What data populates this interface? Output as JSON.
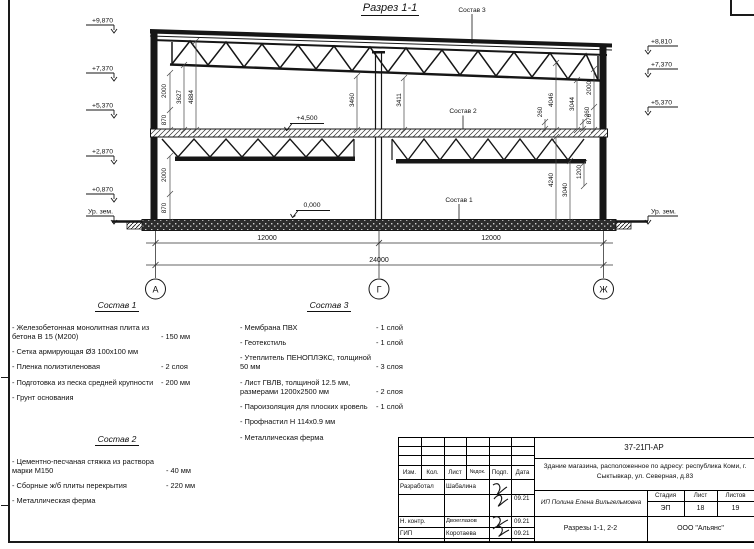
{
  "drawing": {
    "title": "Разрез 1-1",
    "callout_1": "Состав 1",
    "callout_2": "Состав 2",
    "callout_3": "Состав 3",
    "levels_left": {
      "l1": "+9,870",
      "l2": "+7,370",
      "l3": "+5,370",
      "l4": "+2,870",
      "l5": "+0,870",
      "ground": "Ур. зем."
    },
    "levels_right": {
      "l1": "+8,810",
      "l2": "+7,370",
      "l3": "+5,370",
      "ground": "Ур. зем."
    },
    "floor_levels": {
      "second": "+4,500",
      "first": "0,000"
    },
    "dims": {
      "wall_top_left_2000": "2000",
      "wall_top_left_870": "870",
      "bay1_3627": "3627",
      "bay1_4884": "4884",
      "bay1_3460": "3460",
      "bay2_3411": "3411",
      "bay2_4046": "4046",
      "bay2_3044": "3044",
      "slab_260a": "260",
      "slab_260b": "260",
      "wall_top_right_2000": "2000",
      "wall_top_right_870": "870",
      "wall_bot_left_2000": "2000",
      "wall_bot_left_870": "870",
      "bay2_4240": "4240",
      "bay2_3040": "3040",
      "bay2_1200": "1200",
      "span1": "12000",
      "span2": "12000",
      "total": "24000"
    },
    "axes": {
      "a": "А",
      "g": "Г",
      "zh": "Ж"
    }
  },
  "legend1": {
    "title": "Состав 1",
    "items": [
      {
        "name": "- Железобетонная  монолитная плита из бетона В 15 (М200)",
        "qty": "- 150 мм"
      },
      {
        "name": "- Сетка армирующая Ø3 100х100 мм",
        "qty": ""
      },
      {
        "name": "- Пленка полиэтиленовая",
        "qty": "-  2 слоя"
      },
      {
        "name": "- Подготовка из песка средней крупности",
        "qty": "- 200 мм"
      },
      {
        "name": "- Грунт основания",
        "qty": ""
      }
    ]
  },
  "legend2": {
    "title": "Состав 2",
    "items": [
      {
        "name": "- Цементно-песчаная стяжка из раствора марки М150",
        "qty": "- 40 мм"
      },
      {
        "name": "- Сборные ж/б плиты перекрытия",
        "qty": "- 220 мм"
      },
      {
        "name": "- Металлическая ферма",
        "qty": ""
      }
    ]
  },
  "legend3": {
    "title": "Состав 3",
    "items": [
      {
        "name": "- Мембрана ПВХ",
        "qty": "- 1 слой"
      },
      {
        "name": "- Геотекстиль",
        "qty": "- 1 слой"
      },
      {
        "name": "- Утеплитель ПЕНОПЛЭКС, толщиной 50 мм",
        "qty": "- 3 слоя"
      },
      {
        "name": "- Лист ГВЛВ, толщиной 12.5 мм, размерами 1200х2500 мм",
        "qty": "- 2 слоя"
      },
      {
        "name": "- Пароизоляция для плоских кровель",
        "qty": "- 1 слой"
      },
      {
        "name": "- Профнастил Н 114х0.9 мм",
        "qty": ""
      },
      {
        "name": "- Металлическая ферма",
        "qty": ""
      }
    ]
  },
  "titleblock": {
    "doc_number": "37-21П-АР",
    "object": "Здание магазина, расположенное по адресу: республика Коми, г. Сыктывкар, ул. Северная, д.83",
    "cols": [
      "Изм.",
      "Кол.",
      "Лист",
      "№док.",
      "Подп.",
      "Дата"
    ],
    "row_dev": {
      "role": "Разработал",
      "name": "Шабалина",
      "date": "09.21"
    },
    "row_nc": {
      "role": "Н. контр.",
      "name": "Двоеглазов",
      "date": "09.21"
    },
    "row_gip": {
      "role": "ГИП",
      "name": "Коротаева",
      "date": "09.21"
    },
    "client": "ИП Полина Елена Вильгельмовна",
    "stage_label": "Стадия",
    "sheet_label": "Лист",
    "sheets_label": "Листов",
    "stage": "ЭП",
    "sheet": "18",
    "sheets": "19",
    "sheet_title": "Разрезы 1-1, 2-2",
    "company": "ООО \"Альянс\""
  }
}
